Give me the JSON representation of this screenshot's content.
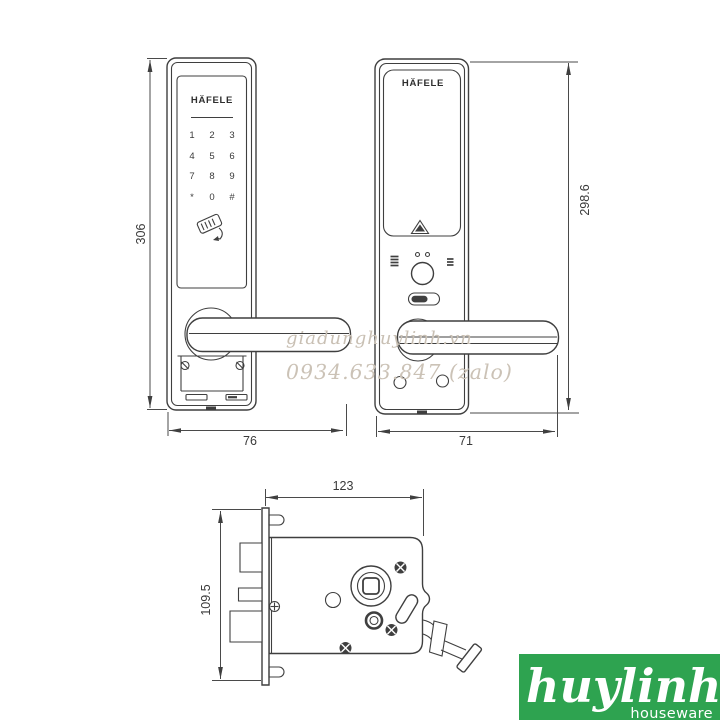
{
  "watermark": {
    "line1": "giadunghuylinh.vn",
    "line2": "0934.633.847 (zalo)"
  },
  "logo": {
    "name": "huylinh",
    "tagline": "houseware",
    "bg_color": "#2ea350",
    "text_color": "#ffffff"
  },
  "front_view": {
    "brand": "HÄFELE",
    "keypad": [
      "1",
      "2",
      "3",
      "4",
      "5",
      "6",
      "7",
      "8",
      "9",
      "*",
      "0",
      "#"
    ],
    "dim_height": "306",
    "dim_width": "76"
  },
  "back_view": {
    "brand": "HÄFELE",
    "dim_height": "298.6",
    "dim_width": "71"
  },
  "mortise_view": {
    "dim_width": "123",
    "dim_height": "109.5"
  },
  "colors": {
    "line": "#3f3f3f",
    "dimension_text": "#3a3a3a",
    "watermark": "#c9c0b4",
    "logo_green": "#2ea350"
  }
}
